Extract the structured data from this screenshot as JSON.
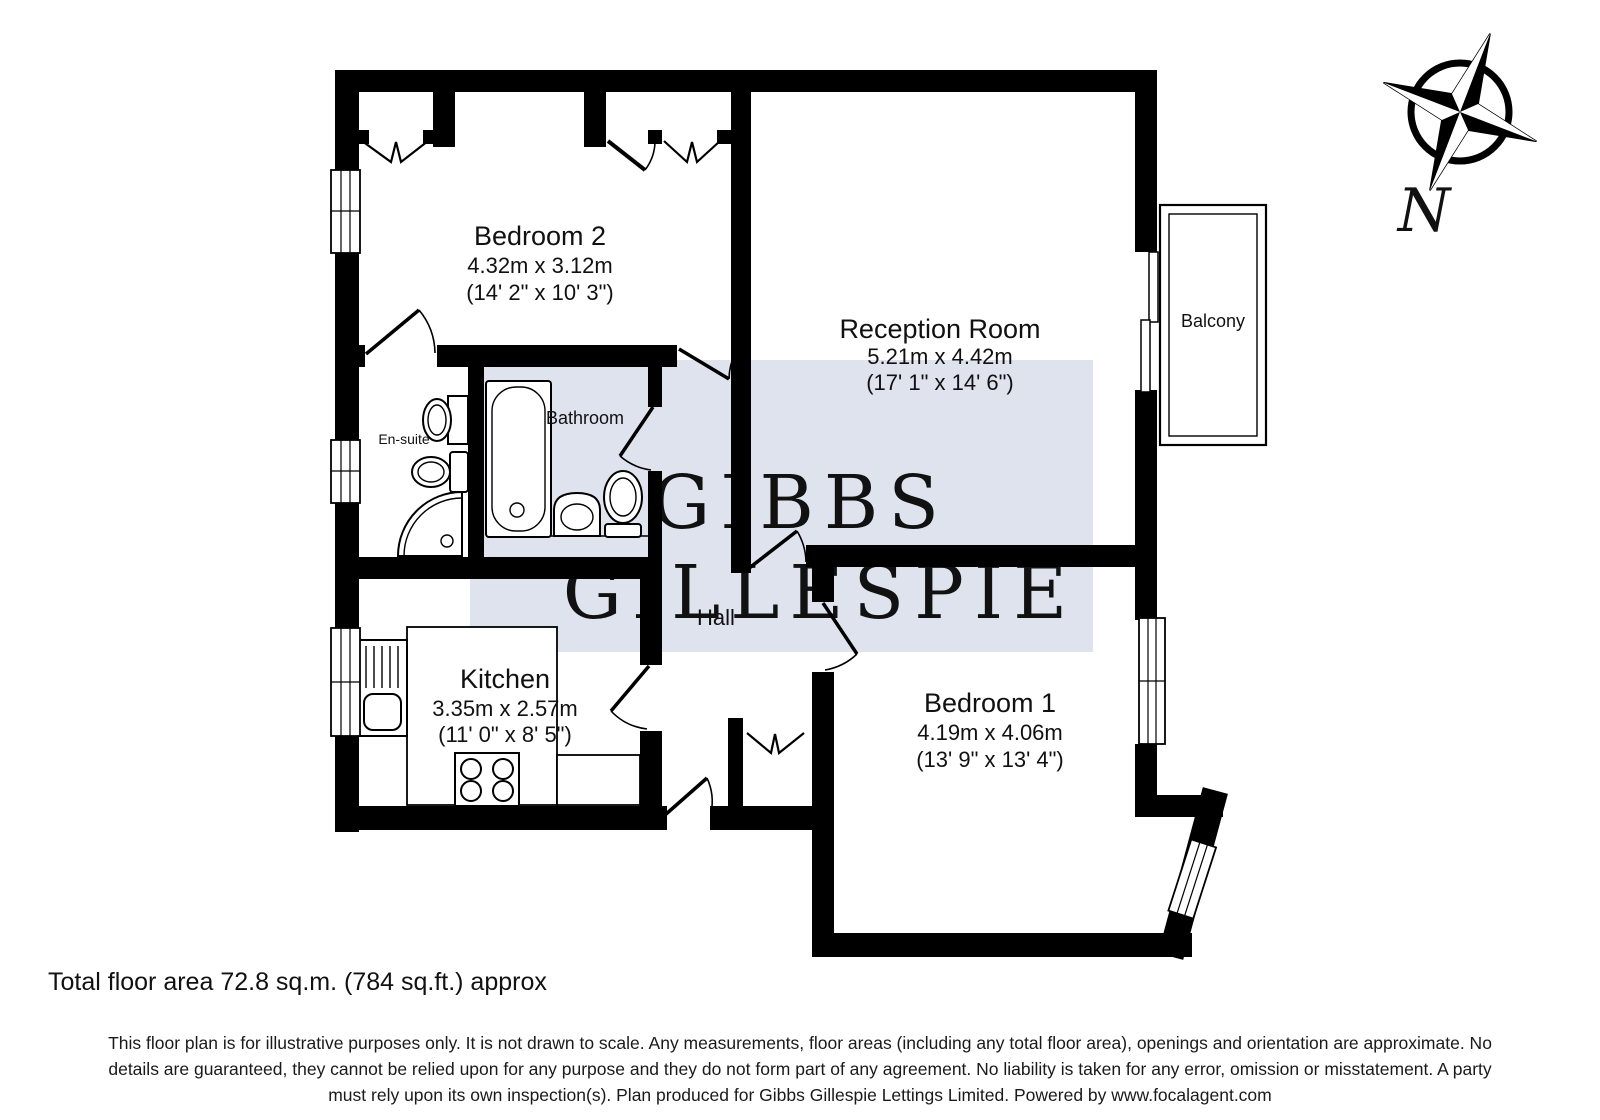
{
  "plan": {
    "rooms": {
      "bedroom2": {
        "name": "Bedroom 2",
        "metric": "4.32m x 3.12m",
        "imperial": "(14' 2\" x 10' 3\")"
      },
      "reception": {
        "name": "Reception Room",
        "metric": "5.21m x 4.42m",
        "imperial": "(17' 1\" x 14' 6\")"
      },
      "bedroom1": {
        "name": "Bedroom 1",
        "metric": "4.19m x 4.06m",
        "imperial": "(13' 9\" x 13' 4\")"
      },
      "kitchen": {
        "name": "Kitchen",
        "metric": "3.35m x 2.57m",
        "imperial": "(11' 0\" x 8' 5\")"
      },
      "bathroom": {
        "name": "Bathroom"
      },
      "ensuite": {
        "name": "En-suite"
      },
      "hall": {
        "name": "Hall"
      },
      "balcony": {
        "name": "Balcony"
      }
    },
    "compass": {
      "north_label": "N"
    },
    "watermark": {
      "line1": "GIBBS",
      "line2": "GILLESPIE",
      "bg_color": "#dfe3ee",
      "text_color": "#ffffff"
    },
    "wall_color": "#000000"
  },
  "footer": {
    "total_area": "Total floor area 72.8 sq.m. (784 sq.ft.) approx",
    "disclaimer_line1": "This floor plan is for illustrative purposes only. It is not drawn to scale. Any measurements, floor areas (including any total floor area), openings and orientation are approximate. No",
    "disclaimer_line2": "details are guaranteed, they cannot be relied upon for any purpose and they do not form part of any agreement. No liability is taken for any error, omission or misstatement. A party",
    "disclaimer_line3": "must rely upon its own inspection(s). Plan produced for Gibbs Gillespie Lettings Limited. Powered by www.focalagent.com"
  }
}
